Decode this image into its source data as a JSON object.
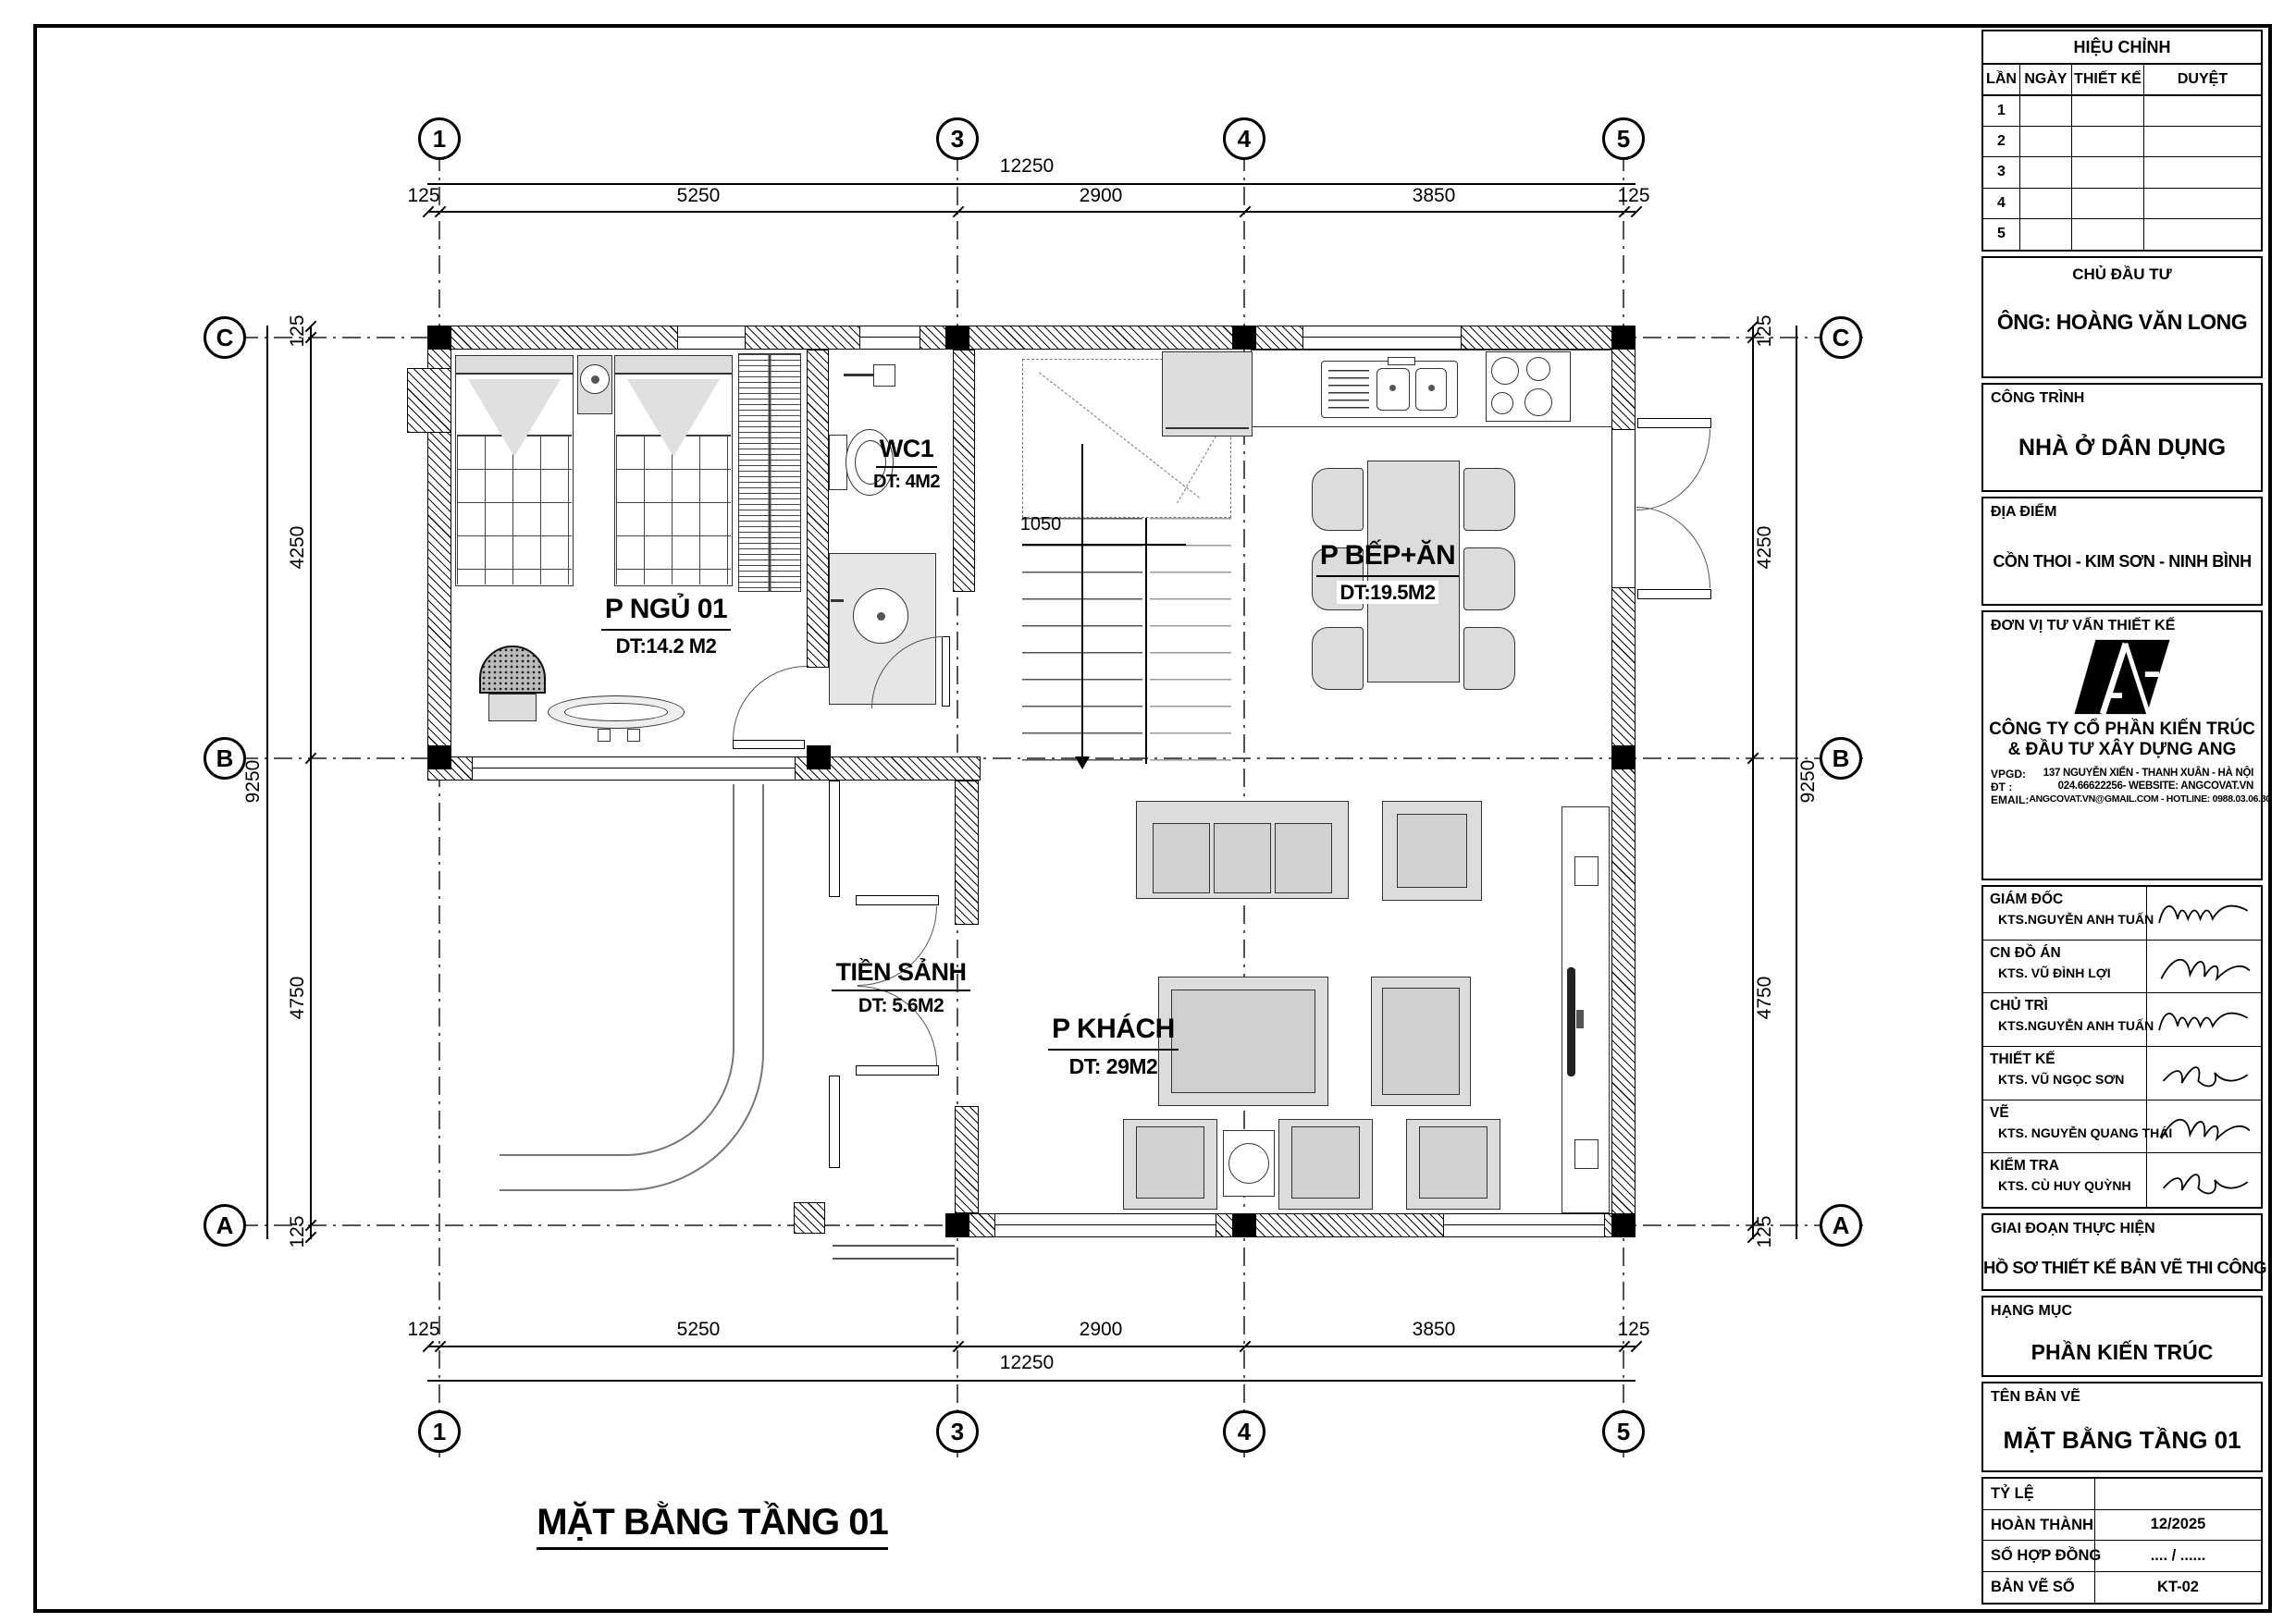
{
  "sheet": {
    "title": "MẶT BẰNG TẦNG 01",
    "stair_dim": "1050"
  },
  "grid": {
    "cols": [
      "1",
      "3",
      "4",
      "5"
    ],
    "rows": [
      "C",
      "B",
      "A"
    ]
  },
  "dimensions": {
    "top_total": "12250",
    "top_segments": [
      "125",
      "5250",
      "2900",
      "3850",
      "125"
    ],
    "bottom_total": "12250",
    "bottom_segments": [
      "125",
      "5250",
      "2900",
      "3850",
      "125"
    ],
    "left_total": "9250",
    "left_segments": [
      "125",
      "4250",
      "4750",
      "125"
    ],
    "right_total": "9250",
    "right_segments": [
      "125",
      "4250",
      "4750",
      "125"
    ]
  },
  "rooms": [
    {
      "name": "P NGỦ 01",
      "area": "DT:14.2 M2"
    },
    {
      "name": "WC1",
      "area": "DT: 4M2"
    },
    {
      "name": "P BẾP+ĂN",
      "area": "DT:19.5M2"
    },
    {
      "name": "TIỀN SẢNH",
      "area": "DT: 5.6M2"
    },
    {
      "name": "P KHÁCH",
      "area": "DT: 29M2"
    }
  ],
  "titleblock": {
    "revision": {
      "title": "HIỆU CHỈNH",
      "cols": [
        "LẦN",
        "NGÀY",
        "THIẾT KẾ",
        "DUYỆT"
      ],
      "rows": [
        "1",
        "2",
        "3",
        "4",
        "5"
      ]
    },
    "client": {
      "label": "CHỦ ĐẦU TƯ",
      "value": "ÔNG: HOÀNG VĂN LONG"
    },
    "project": {
      "label": "CÔNG TRÌNH",
      "value": "NHÀ Ở DÂN DỤNG"
    },
    "location": {
      "label": "ĐỊA ĐIỂM",
      "value": "CỒN THOI - KIM SƠN - NINH BÌNH"
    },
    "consultant": {
      "label": "ĐƠN VỊ TƯ VẤN THIẾT KẾ",
      "company_line1": "CÔNG TY CỔ PHẦN KIẾN TRÚC",
      "company_line2": "& ĐẦU TƯ XÂY DỰNG ANG",
      "vpgd_label": "VPGD:",
      "vpgd": "137 NGUYỄN XIỂN - THANH XUÂN - HÀ NỘI",
      "dt_label": "ĐT :",
      "dt": "024.66622256- WEBSITE: ANGCOVAT.VN",
      "email_label": "EMAIL:",
      "email": "ANGCOVAT.VN@GMAIL.COM - HOTLINE: 0988.03.06.80"
    },
    "signers": [
      {
        "role": "GIÁM ĐỐC",
        "name": "KTS.NGUYỄN ANH TUẤN"
      },
      {
        "role": "CN ĐỒ ÁN",
        "name": "KTS. VŨ ĐÌNH LỢI"
      },
      {
        "role": "CHỦ TRÌ",
        "name": "KTS.NGUYỄN ANH TUẤN"
      },
      {
        "role": "THIẾT KẾ",
        "name": "KTS. VŨ NGỌC SƠN"
      },
      {
        "role": "VẼ",
        "name": "KTS. NGUYỄN QUANG THÁI"
      },
      {
        "role": "KIỂM TRA",
        "name": "KTS. CÙ HUY QUỲNH"
      }
    ],
    "phase": {
      "label": "GIAI ĐOẠN THỰC HIỆN",
      "value": "HỒ SƠ THIẾT KẾ BẢN VẼ THI CÔNG"
    },
    "category": {
      "label": "HẠNG MỤC",
      "value": "PHẦN KIẾN TRÚC"
    },
    "drawing_name": {
      "label": "TÊN BẢN VẼ",
      "value": "MẶT BẰNG TẦNG 01"
    },
    "meta": [
      {
        "label": "TỶ LỆ",
        "value": ""
      },
      {
        "label": "HOÀN THÀNH",
        "value": "12/2025"
      },
      {
        "label": "SỐ HỢP ĐỒNG",
        "value": ".... / ......"
      },
      {
        "label": "BẢN VẼ SỐ",
        "value": "KT-02"
      }
    ]
  }
}
